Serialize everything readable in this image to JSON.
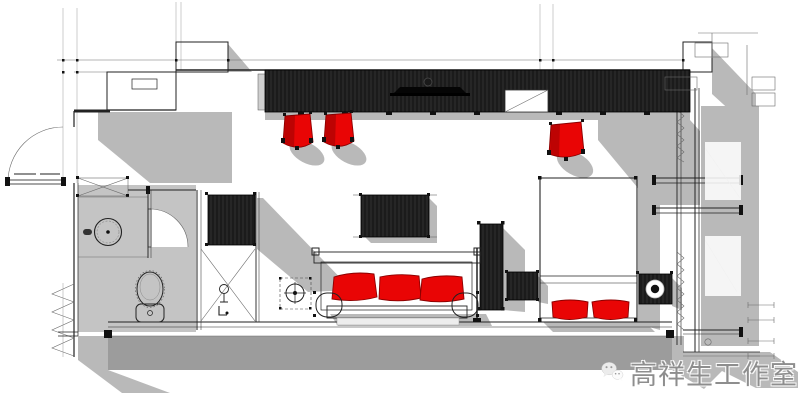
{
  "watermark": {
    "text": "高祥生工作室",
    "icon": "wechat-icon"
  },
  "colors": {
    "background": "#ffffff",
    "accent_red": "#e90505",
    "furniture_black": "#1b1b1b",
    "shadow_gray": "#b9b9b9",
    "floor_gray": "#c4c4c4",
    "wall_gray": "#9c9c9c",
    "line_dark": "#222222",
    "watermark_gray": "#8e8e8e"
  },
  "plan": {
    "type": "interior-floor-plan",
    "elements": [
      "entry-door",
      "entry-closet",
      "luggage-rack",
      "vanity-counter",
      "round-basin",
      "toilet",
      "shower-enclosure",
      "floor-drain",
      "wardrobe",
      "tv-wall-cabinet",
      "lounge-chair",
      "lounge-chair",
      "lounge-chair",
      "tv-panel",
      "sofa",
      "sofa-cushion",
      "sofa-cushion",
      "sofa-cushion",
      "tall-cabinet",
      "nightstand",
      "bed",
      "pillow",
      "pillow",
      "speaker-nightstand",
      "window-wall"
    ]
  }
}
